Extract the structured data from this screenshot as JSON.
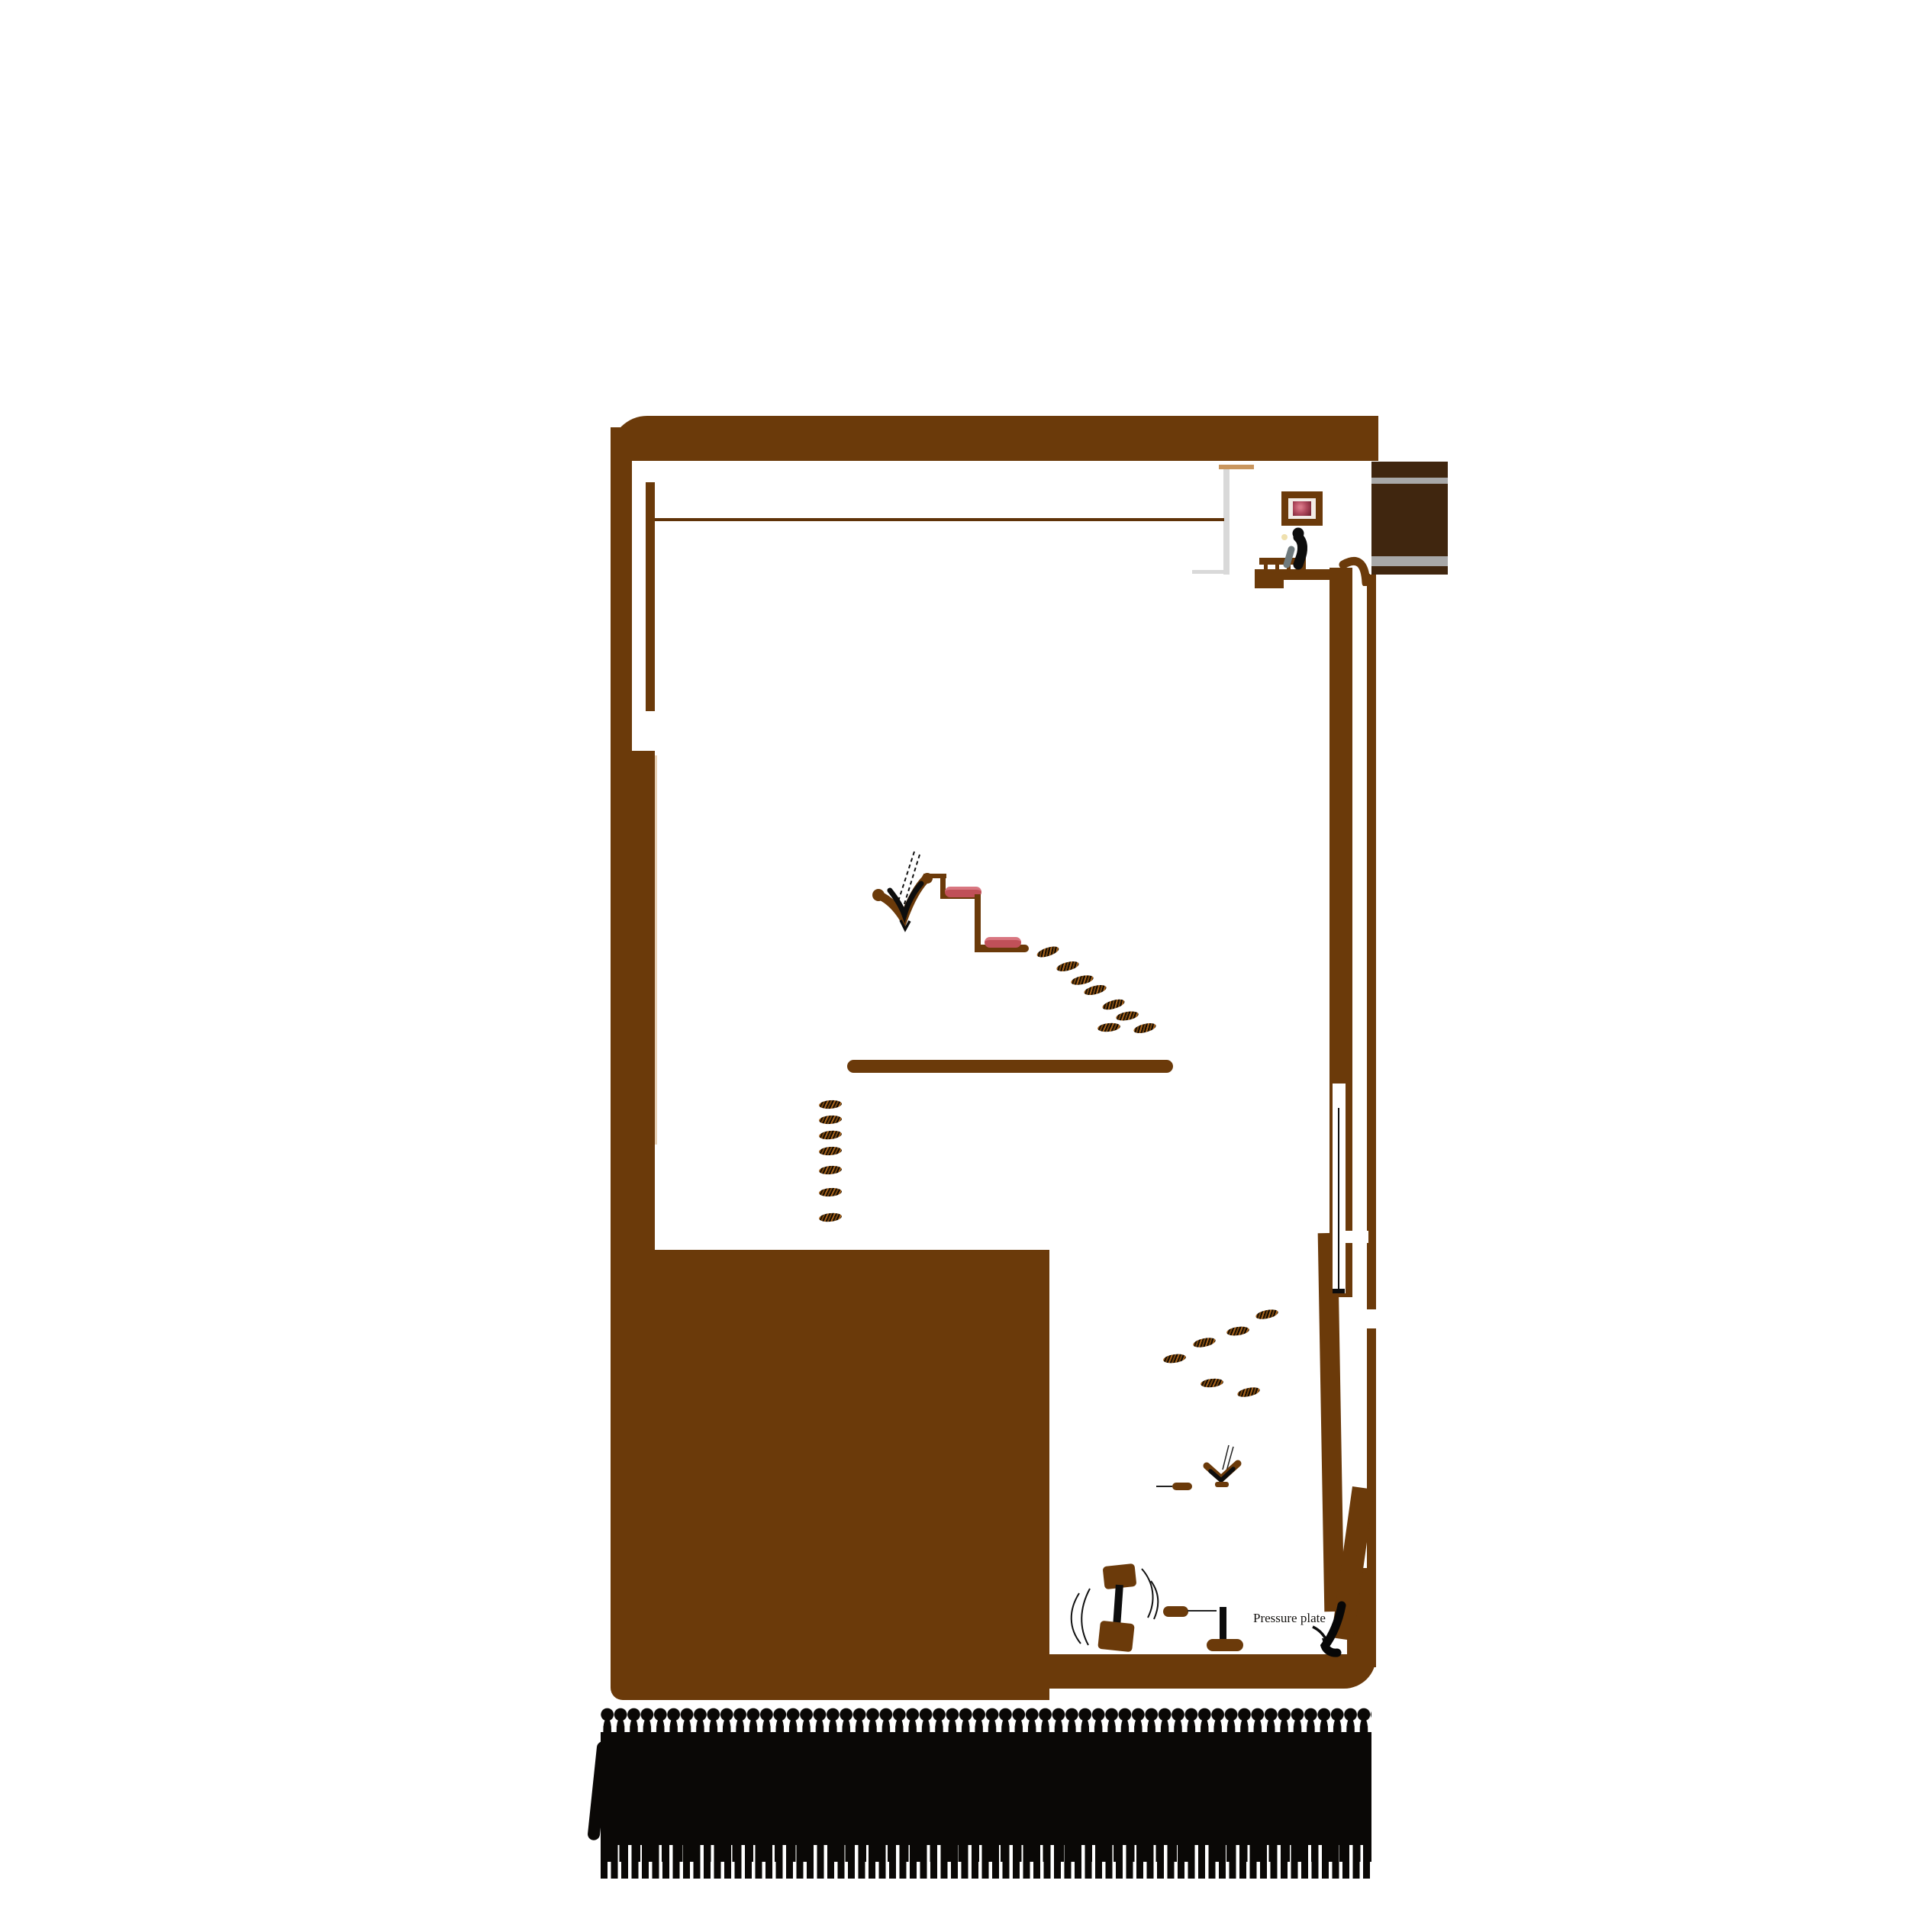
{
  "annotations": {
    "pressure_plate": "Pressure plate"
  },
  "colors": {
    "c-bg": "#ffffff",
    "c-wall": "#6b3a0a",
    "c-walldark": "#40260f",
    "c-stripe": "#a8a8a8",
    "c-roomgray": "#d9d9d9",
    "c-tan": "#c9965e",
    "c-cushion": "#c05058",
    "c-cushionlight": "#d87680",
    "c-footprint": "#7d4a10",
    "c-ink": "#0d0d0d",
    "c-crowd": "#0a0806",
    "c-picture": "#b04a5e"
  },
  "features": {
    "structure": "hand-drawn building cross-section with brown walls",
    "upper_room": "small room with framed picture and seated figure on bench",
    "corridor": "dark striped passage leading right from upper room",
    "steps": "two descending ledges with red cushions",
    "jumping_figure": "sketched figure diving down beside the steps",
    "platform": "long horizontal ledge mid-level",
    "hanging_rope": "rope with bar inside right wall slot",
    "chute": "white gap running down the right wall to the corner",
    "dumbbell": "swinging weight object near bottom room",
    "lever": "upright lever on rounded base",
    "pressure_plate": "black curved plate in bottom-right corner",
    "crowd": "dense row of black figure silhouettes below the structure"
  },
  "footprint_trails": {
    "diagonal_from_steps": 8,
    "vertical_drop": 7,
    "lower_right": 6
  }
}
